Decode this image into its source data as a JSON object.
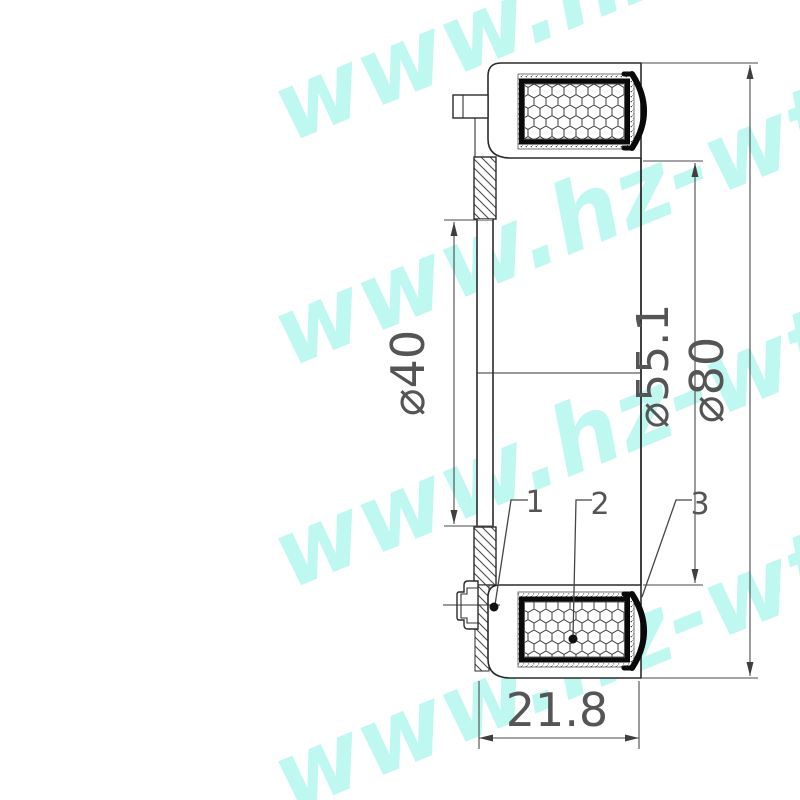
{
  "watermark": {
    "text": "www.hz-wt.c"
  },
  "drawing": {
    "dimensions": {
      "phi40": "⌀40",
      "phi55": "⌀55.1",
      "phi80": "⌀80",
      "width": "21.8"
    },
    "callouts": {
      "c1": "1",
      "c2": "2",
      "c3": "3"
    },
    "colors": {
      "line": "#2b2b2b",
      "coil_border": "#0a0a0a",
      "watermark": "#a8efe6"
    }
  }
}
